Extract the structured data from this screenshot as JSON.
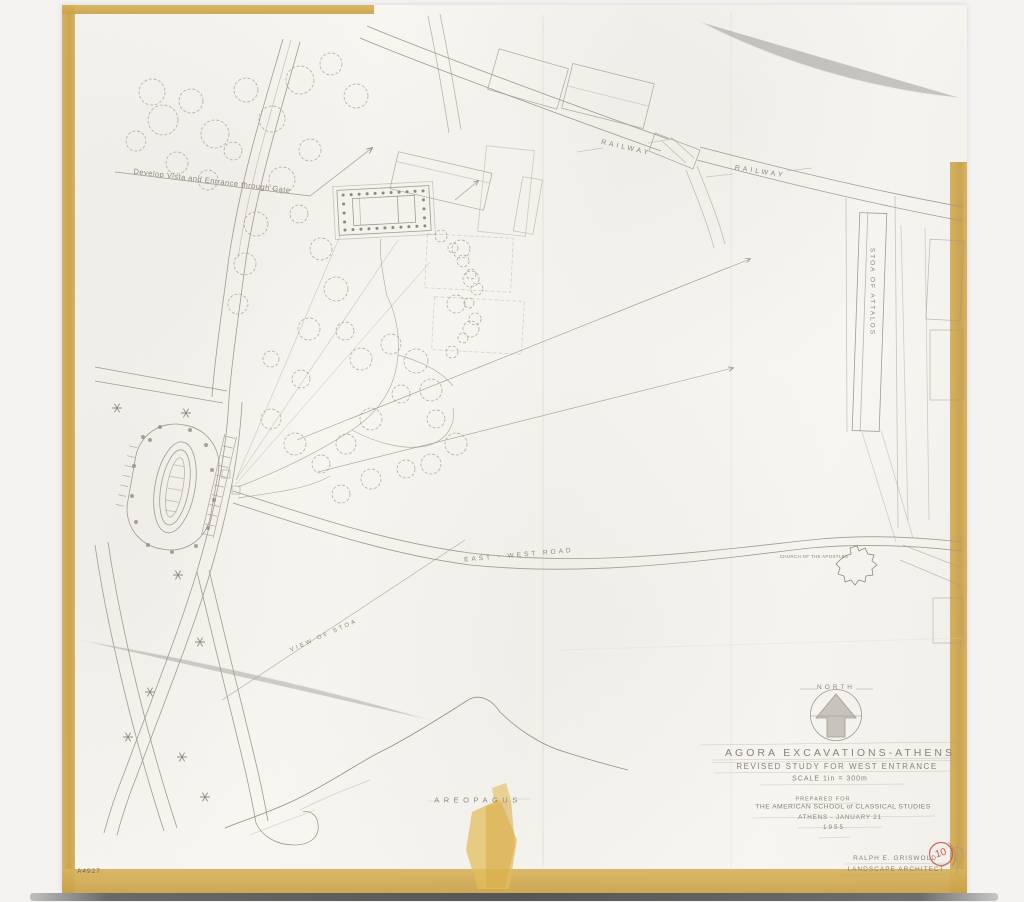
{
  "drawing": {
    "number": "A4927",
    "title": "AGORA EXCAVATIONS-ATHENS",
    "subtitle": "REVISED STUDY FOR WEST ENTRANCE",
    "scale": "SCALE 1in = 300m",
    "prepared_for": "PREPARED FOR",
    "client": "THE AMERICAN SCHOOL of CLASSICAL STUDIES",
    "place_date": "ATHENS - JANUARY 21",
    "year": "1955",
    "architect": "RALPH E. GRISWOLD",
    "architect_title": "LANDSCAPE ARCHITECT",
    "stamp_number": "10"
  },
  "labels": {
    "railway_west": "RAILWAY",
    "railway_east": "RAILWAY",
    "stoa_of_attalos": "STOA OF ATTALOS",
    "east_west_road": "EAST - WEST ROAD",
    "church_of_the_apostles": "CHURCH OF THE APOSTLES",
    "areopagus": "AREOPAGUS",
    "north": "NORTH",
    "view_of_stoa": "VIEW OF STOA",
    "annotation": "Develop Vista and Entrance through Gate"
  },
  "colors": {
    "paper": "#f6f4ef",
    "pencil": "#a29b8f",
    "tape": "#cfa84f",
    "red_stamp": "#c2574a"
  }
}
